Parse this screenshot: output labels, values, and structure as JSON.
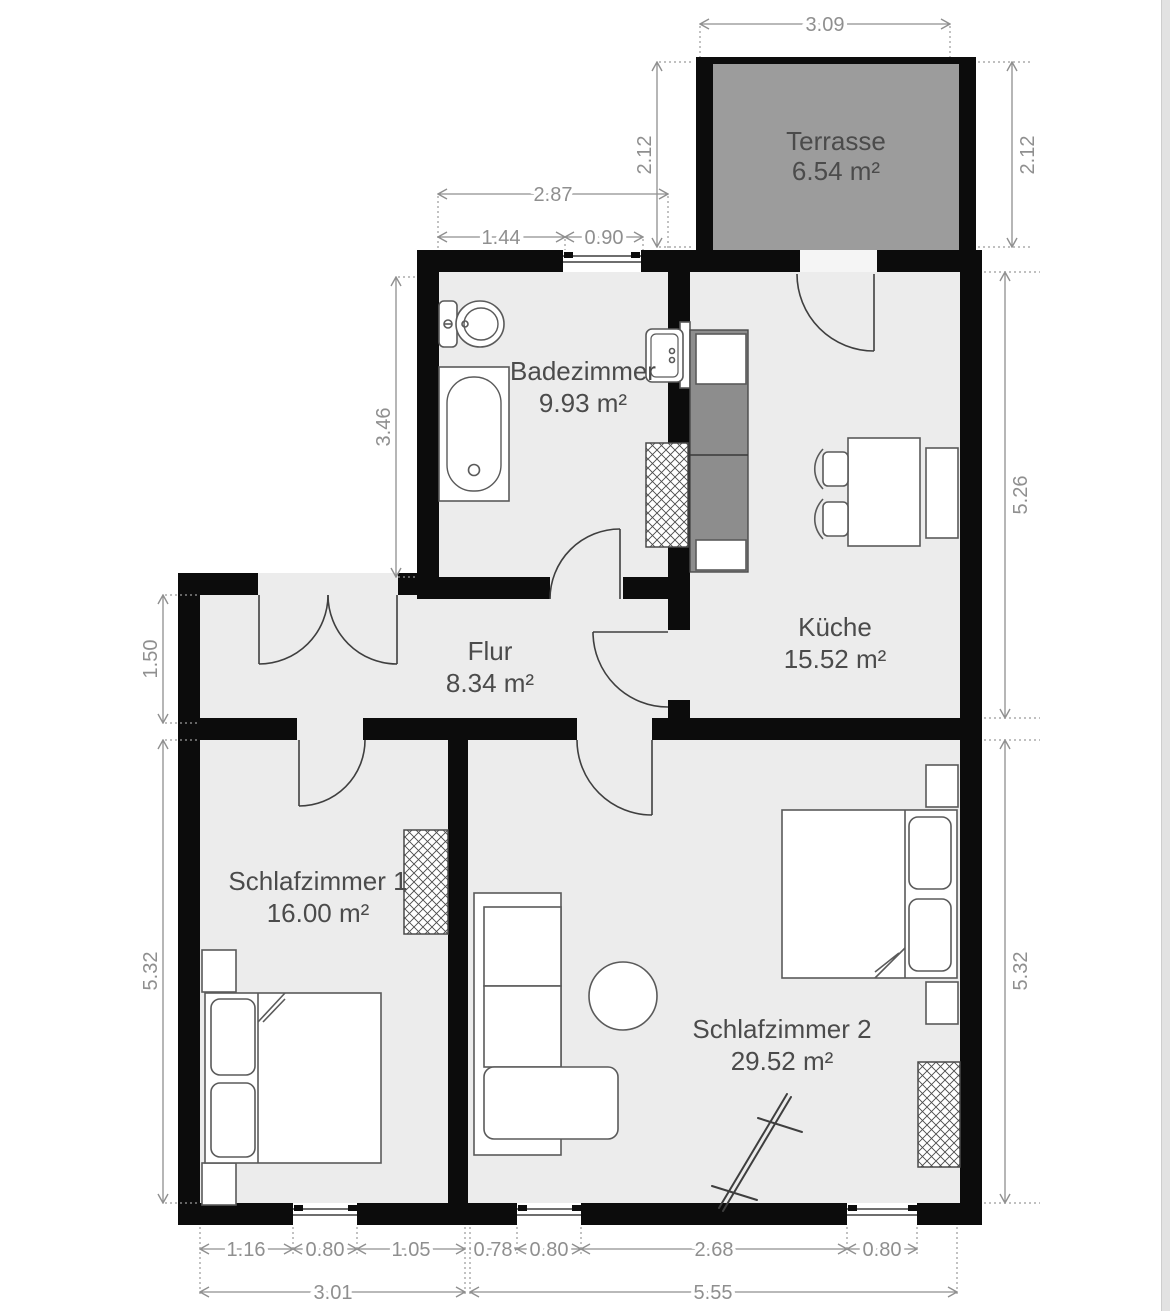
{
  "title": "apartment-floor-plan",
  "colors": {
    "wall": "#0c0c0c",
    "room_fill": "#ececec",
    "terrace_fill": "#9c9c9c",
    "kitchen_counter": "#8d8d8d",
    "dimension_gray": "#8f8f8f",
    "label_gray": "#4b4b4b"
  },
  "rooms": {
    "terrasse": {
      "name": "Terrasse",
      "area": "6.54 m²"
    },
    "badezimmer": {
      "name": "Badezimmer",
      "area": "9.93 m²"
    },
    "kueche": {
      "name": "Küche",
      "area": "15.52 m²"
    },
    "flur": {
      "name": "Flur",
      "area": "8.34 m²"
    },
    "schlafzimmer1": {
      "name": "Schlafzimmer 1",
      "area": "16.00 m²"
    },
    "schlafzimmer2": {
      "name": "Schlafzimmer 2",
      "area": "29.52 m²"
    }
  },
  "dimensions": {
    "terrace_width": "3.09",
    "terrace_height_left": "2.12",
    "terrace_height_right": "2.12",
    "bath_top_total": "2.87",
    "bath_top_left": "1.44",
    "bath_window": "0.90",
    "bath_height": "3.46",
    "kitchen_height": "5.26",
    "flur_height": "1.50",
    "bedroom1_height": "5.32",
    "bedroom2_height": "5.32",
    "bottom_b1_left": "1.16",
    "bottom_b1_window": "0.80",
    "bottom_b1_right": "1.05",
    "bottom_b2_left": "0.78",
    "bottom_b2_window1": "0.80",
    "bottom_b2_mid": "2.68",
    "bottom_b2_window2": "0.80",
    "bottom_total_left": "3.01",
    "bottom_total_right": "5.55"
  }
}
